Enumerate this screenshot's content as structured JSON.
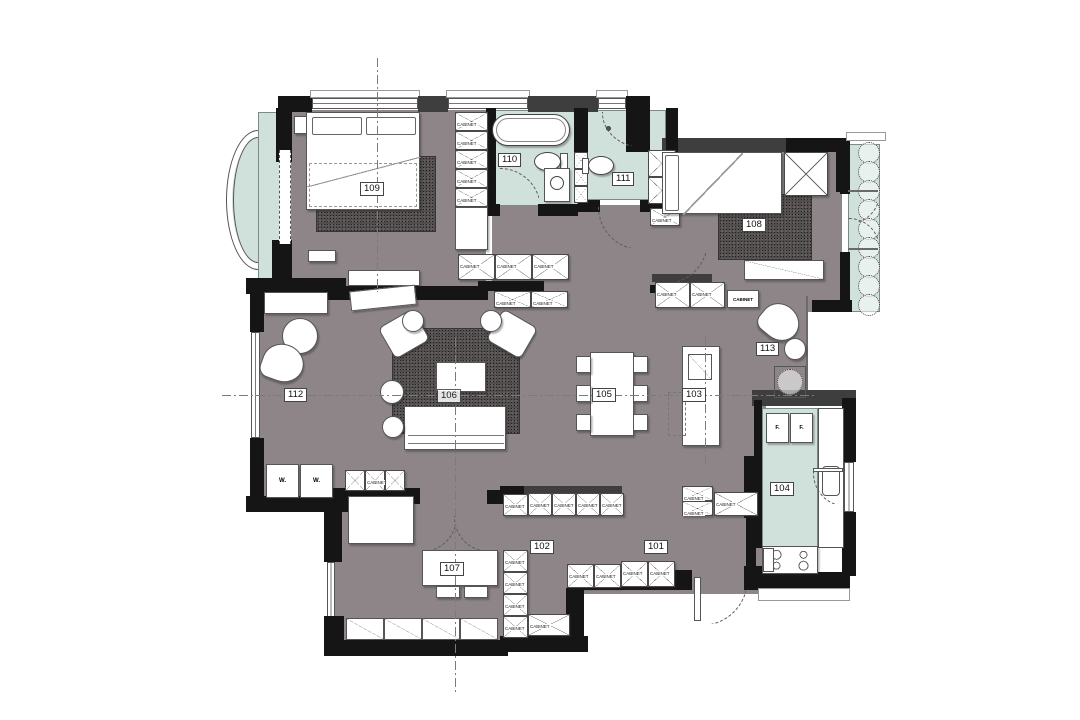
{
  "title": "Residential apartment floor plan",
  "colors": {
    "paper": "#ffffff",
    "floor": "#8d8587",
    "wall": "#151515",
    "wall_dark": "#3f3e3e",
    "green": "#cfe1da",
    "rug": "#524e4e"
  },
  "labels": {
    "cabinet": "CABINET",
    "washer": "W.",
    "fridge": "F."
  },
  "rooms": {
    "r101": "101",
    "r102": "102",
    "r103": "103",
    "r104": "104",
    "r105": "105",
    "r106": "106",
    "r107": "107",
    "r108": "108",
    "r109": "109",
    "r110": "110",
    "r111": "111",
    "r112": "112",
    "r113": "113"
  }
}
